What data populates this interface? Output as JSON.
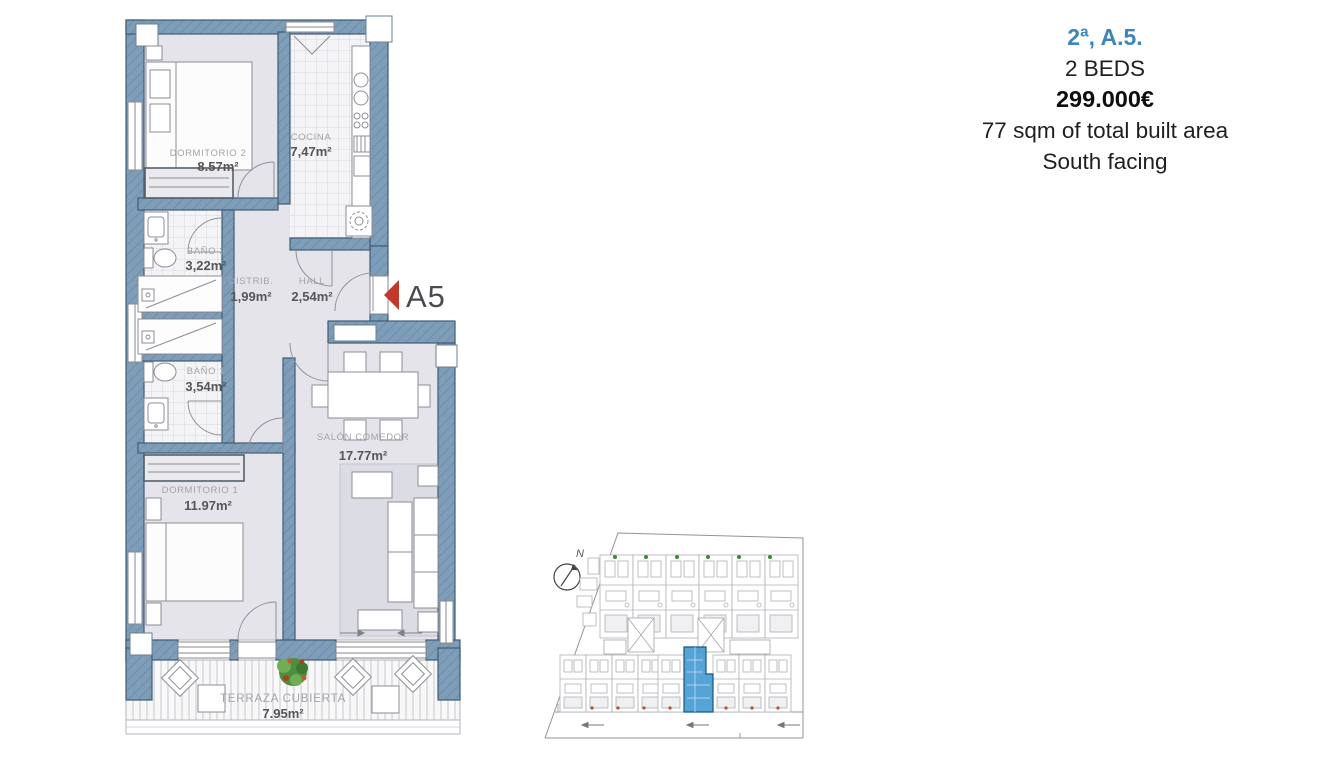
{
  "info_panel": {
    "unit_ref": "2ª, A.5.",
    "beds": "2 BEDS",
    "price": "299.000€",
    "built_area": "77 sqm of total built area",
    "orientation": "South facing",
    "accent_color": "#3e86ba"
  },
  "floor_plan": {
    "unit_label": "A5",
    "rooms": [
      {
        "name": "DORMITORIO 2",
        "area": "8.57m²"
      },
      {
        "name": "COCINA",
        "area": "7,47m²"
      },
      {
        "name": "BAÑO 2",
        "area": "3,22m²"
      },
      {
        "name": "DISTRIB.",
        "area": "1,99m²"
      },
      {
        "name": "HALL",
        "area": "2,54m²"
      },
      {
        "name": "BAÑO 1",
        "area": "3,54m²"
      },
      {
        "name": "DORMITORIO 1",
        "area": "11.97m²"
      },
      {
        "name": "SALÓN COMEDOR",
        "area": "17.77m²"
      },
      {
        "name": "TERRAZA CUBIERTA",
        "area": "7.95m²"
      }
    ],
    "colors": {
      "wall": "#7e9db9",
      "wall_stroke": "#405c75",
      "floor": "#e4e4ea",
      "arrow_red": "#c0392b",
      "site_highlight": "#3f97d0"
    }
  },
  "site_plan": {
    "compass_label": "N"
  }
}
